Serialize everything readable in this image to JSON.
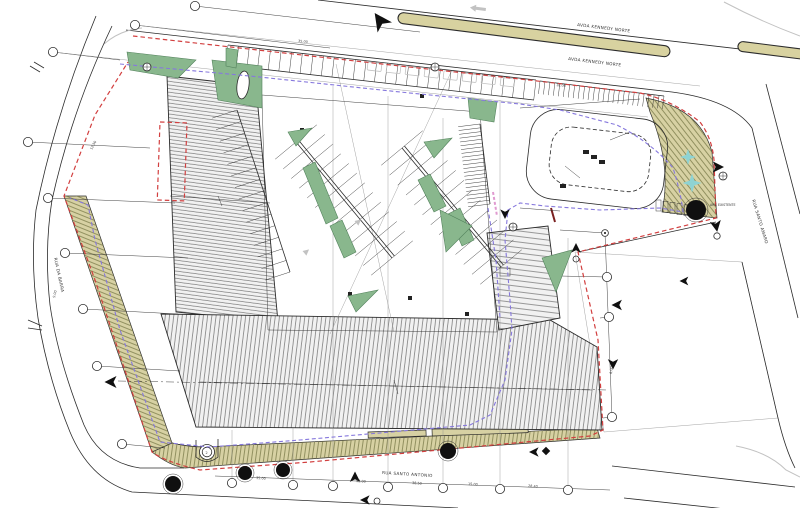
{
  "labels": {
    "road_top_outer": "AVDA KENNEDY NORTE",
    "road_top_inner": "AVDA KENNEDY NORTE",
    "road_right": "RUA SANTO AMARO",
    "road_bottom": "RUA SANTO ANTONIO",
    "road_left": "RUA DA BARRA",
    "tree_note": "ARV. EXISTENTE"
  },
  "dimensions": [
    "35.00",
    "52.00",
    "38.50",
    "15.00",
    "28.40",
    "9.00",
    "12.50",
    "6.00",
    "35.00",
    "18.00"
  ],
  "counts": {
    "grid_bubbles_left": 6,
    "grid_bubbles_top": 3,
    "grid_bubbles_bottom": 7,
    "grid_bubbles_right": 4,
    "trees": 5,
    "planting_stars": 2,
    "parking_rows_angled": 2,
    "hatched_roof_areas": 3
  },
  "colors": {
    "paper": "#ffffff",
    "ink": "#2b2b2b",
    "faint": "#8d8d8d",
    "ghost": "#c2c2c2",
    "khaki": "#d8d2a0",
    "tan": "#d7d1a3",
    "tanTick": "#80804f",
    "green": "#89b78d",
    "greenEdge": "#53825c",
    "hatch": "#717171",
    "hatchBg": "#f1f1f1",
    "red": "#d23f3f",
    "purple": "#8678dd",
    "pink": "#e09ad0",
    "maroon": "#7a2020",
    "cyan": "#8ed3d3",
    "tree": "#101010"
  }
}
